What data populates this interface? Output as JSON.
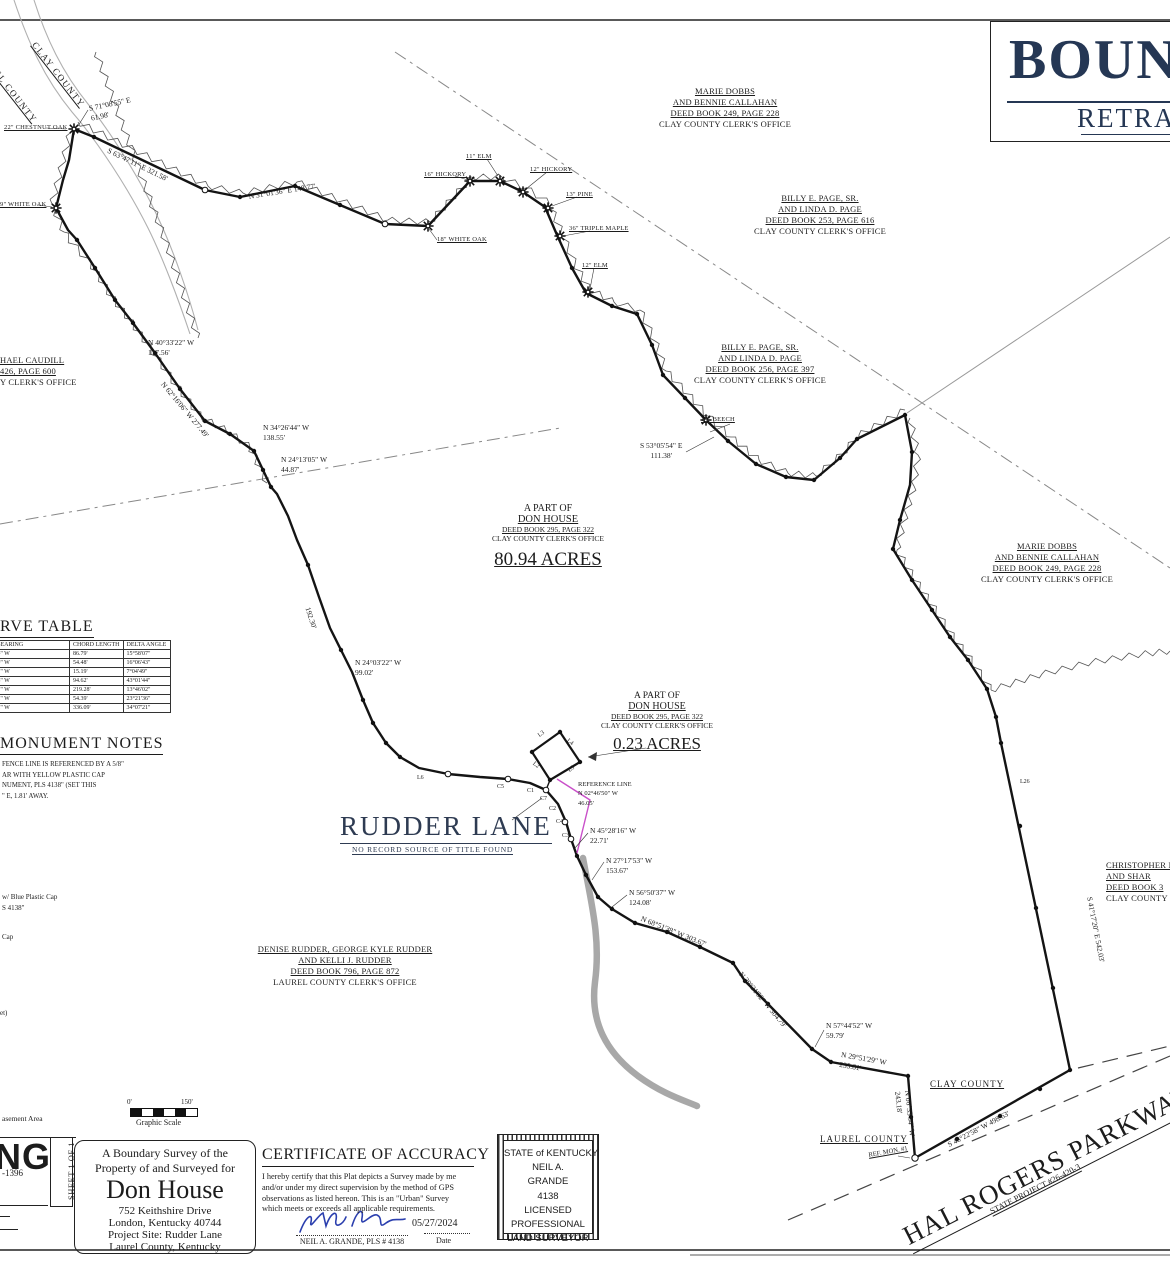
{
  "sheet_title": {
    "line1_partial": "BOUN",
    "line2_partial": "RETRA"
  },
  "map": {
    "counties_topleft": {
      "clay": "CLAY COUNTY",
      "laurel_partial": "EL COUNTY"
    },
    "counties_bottom": {
      "clay": "CLAY COUNTY",
      "laurel": "LAUREL COUNTY"
    },
    "parcel_main": {
      "line1": "A PART OF",
      "line2": "DON HOUSE",
      "line3": "DEED BOOK 295, PAGE 322",
      "line4": "CLAY COUNTY CLERK'S OFFICE",
      "acreage": "80.94 ACRES"
    },
    "parcel_small": {
      "line1": "A PART OF",
      "line2": "DON HOUSE",
      "line3": "DEED BOOK 295, PAGE 322",
      "line4": "CLAY COUNTY CLERK'S OFFICE",
      "acreage": "0.23 ACRES"
    },
    "rudder_lane": {
      "name": "RUDDER LANE",
      "note": "NO RECORD SOURCE OF TITLE FOUND"
    },
    "reference_line": {
      "line1": "REFERENCE LINE",
      "line2": "N 02°46'50\" W",
      "line3": "46.05'"
    },
    "owners": [
      {
        "lines": [
          "MARIE DOBBS",
          "AND BENNIE CALLAHAN",
          "DEED BOOK 249, PAGE 228",
          "CLAY COUNTY CLERK'S OFFICE"
        ]
      },
      {
        "lines": [
          "BILLY E. PAGE, SR.",
          "AND LINDA D. PAGE",
          "DEED BOOK 253, PAGE 616",
          "CLAY COUNTY CLERK'S OFFICE"
        ]
      },
      {
        "lines": [
          "BILLY E. PAGE, SR.",
          "AND LINDA D. PAGE",
          "DEED BOOK 256, PAGE 397",
          "CLAY COUNTY CLERK'S OFFICE"
        ]
      },
      {
        "lines": [
          "MARIE DOBBS",
          "AND BENNIE CALLAHAN",
          "DEED BOOK 249, PAGE 228",
          "CLAY COUNTY CLERK'S OFFICE"
        ]
      },
      {
        "lines": [
          "HAEL CAUDILL",
          "426, PAGE 600",
          "Y CLERK'S OFFICE"
        ]
      },
      {
        "lines": [
          "DENISE RUDDER, GEORGE KYLE RUDDER",
          "AND KELLI J. RUDDER",
          "DEED BOOK 796, PAGE 872",
          "LAUREL COUNTY CLERK'S OFFICE"
        ]
      },
      {
        "lines": [
          "CHRISTOPHER M",
          "AND SHAR",
          "DEED BOOK 3",
          "CLAY COUNTY"
        ]
      }
    ],
    "bearings": [
      {
        "text": "S 71°08'55\" E",
        "text2": "61.98'"
      },
      {
        "text": "N 40°33'22\" W",
        "text2": "117.56'"
      },
      {
        "text": "N 34°26'44\" W",
        "text2": "138.55'"
      },
      {
        "text": "N 24°13'05\" W",
        "text2": "44.87'"
      },
      {
        "text": "N 24°03'22\" W",
        "text2": "99.02'"
      },
      {
        "text": "S 53°05'54\" E",
        "text2": "111.38'"
      },
      {
        "text": "N 45°28'16\" W",
        "text2": "22.71'"
      },
      {
        "text": "N 27°17'53\" W",
        "text2": "153.67'"
      },
      {
        "text": "N 56°50'37\" W",
        "text2": "124.08'"
      },
      {
        "text": "N 57°44'52\" W",
        "text2": "59.79'"
      },
      {
        "text": "N 29°51'29\" W",
        "text2": "235.81'"
      },
      {
        "text": "S 63°47'11\" E  321.58'"
      },
      {
        "text": "N 31°01'36\" E  148.77'"
      },
      {
        "text": "N 62°16'06\" W  277.49'"
      },
      {
        "text": "192.30'"
      },
      {
        "text": "N 68°51'38\" W  303.67'"
      },
      {
        "text": "N 29°21'52\" W  304.79'"
      },
      {
        "text": "N 06°33'54\" W",
        "text2": "243.18'"
      },
      {
        "text": "S 46°22'58\" W  498.63'"
      },
      {
        "text": "S 41°17'20\" E  542.03'"
      }
    ],
    "trees": [
      "22\" CHESTNUT OAK",
      "9\" WHITE OAK",
      "18\" WHITE OAK",
      "16\" HICKORY",
      "11\" ELM",
      "12\" HICKORY",
      "13\" PINE",
      "36\" TRIPLE MAPLE",
      "12\" ELM",
      "14\" BEECH"
    ],
    "line_labels": [
      "L3",
      "L4",
      "L2",
      "L5",
      "C1",
      "C2",
      "C3",
      "C4",
      "C5",
      "C7",
      "L6",
      "L26"
    ],
    "ref_mon": "REF. MON. #1",
    "parkway": {
      "name": "HAL ROGERS PARKWAY (KY 9006)",
      "project": "STATE PROJECT #26-420-3"
    }
  },
  "curve_table": {
    "title_partial": "RVE TABLE",
    "headers": [
      "CHORD BEARING",
      "CHORD LENGTH",
      "DELTA ANGLE"
    ],
    "rows": [
      [
        "S 16°29'44\" W",
        "86.79'",
        "15°58'07\""
      ],
      [
        "S 32°12'29\" W",
        "54.48'",
        "16°06'43\""
      ],
      [
        "S 43°48'41\" W",
        "15.19'",
        "7°04'49\""
      ],
      [
        "S 68°51'58\" W",
        "94.62'",
        "43°01'44\""
      ],
      [
        "S 83°35'21\" W",
        "219.28'",
        "13°46'02\""
      ],
      [
        "S 46°16'32\" W",
        "54.39'",
        "23°21'36\""
      ],
      [
        "S 41°54'32\" W",
        "336.09'",
        "34°07'21\""
      ]
    ]
  },
  "monument_notes": {
    "title": "MONUMENT NOTES",
    "lines": [
      "FENCE LINE IS REFERENCED BY A 5/8\"",
      "AR WITH YELLOW PLASTIC CAP",
      "NUMENT, PLS 4138\" (SET THIS",
      "\" E, 1.81' AWAY."
    ]
  },
  "legend_partials": [
    "w/ Blue Plastic Cap",
    "S 4138\"",
    "Cap",
    "et)",
    "asement Area"
  ],
  "scale_bar": {
    "start": "0'",
    "end": "150'",
    "label": "Graphic Scale"
  },
  "firm": {
    "logo_partial": "ING",
    "phone_partial": "-1396",
    "sheet": "SHEET 1 OF 1"
  },
  "survey_info": {
    "line1": "A Boundary Survey of the",
    "line2": "Property of and Surveyed for",
    "name": "Don House",
    "addr1": "752 Keithshire Drive",
    "addr2": "London, Kentucky 40744",
    "addr3": "Project Site: Rudder Lane",
    "addr4": "Laurel County, Kentucky"
  },
  "certificate": {
    "title": "CERTIFICATE OF ACCURACY",
    "body": "I hereby certify that this Plat depicts a Survey made by me and/or under my direct supervision by the method of GPS observations as listed hereon.  This is an \"Urban\" Survey which meets or exceeds all applicable requirements.",
    "date": "05/27/2024",
    "surveyor": "NEIL A. GRANDE, PLS # 4138",
    "date_label": "Date"
  },
  "seal": {
    "lines": [
      "STATE of KENTUCKY",
      "NEIL A.",
      "GRANDE",
      "4138",
      "LICENSED",
      "PROFESSIONAL",
      "LAND SURVEYOR"
    ]
  },
  "colors": {
    "ink": "#1c1c1c",
    "navy": "#2b3a55",
    "magenta": "#c94fc9",
    "signature_blue": "#2b3fae",
    "stream_gray": "#a8a8a8"
  }
}
